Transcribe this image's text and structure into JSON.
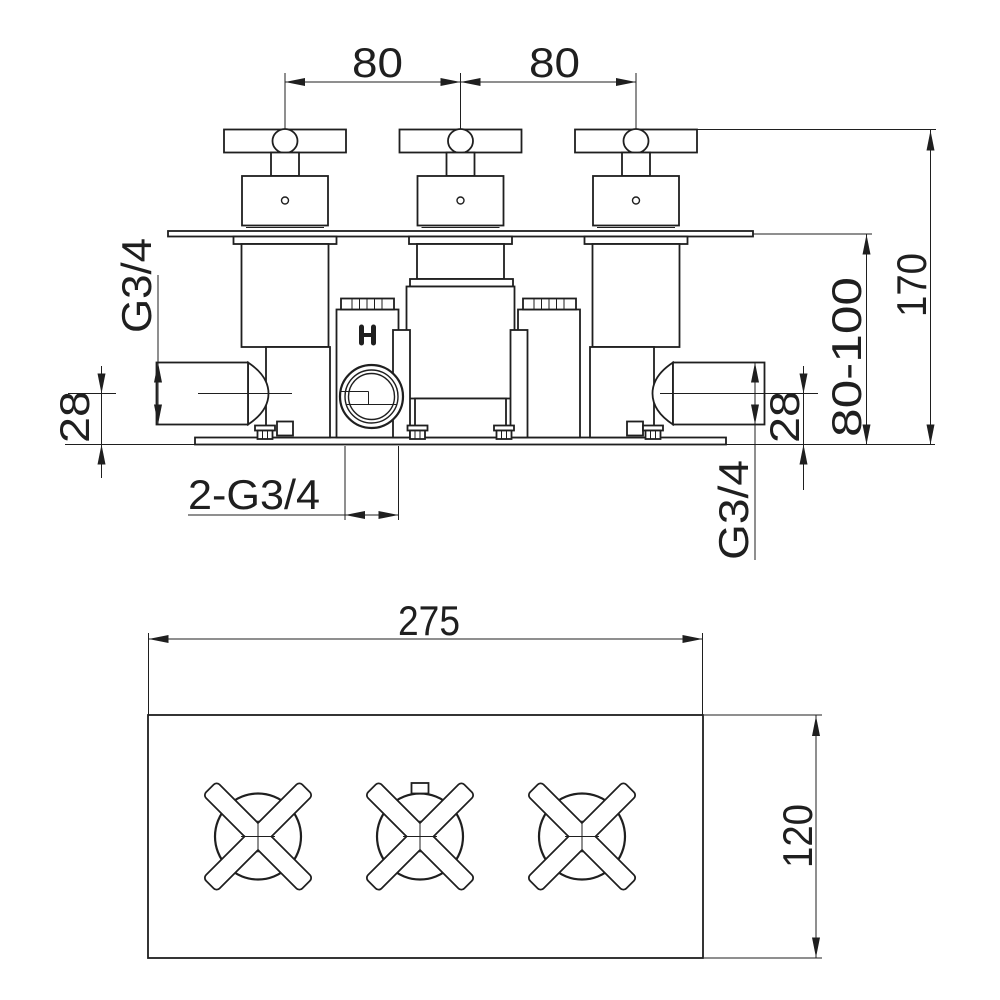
{
  "document": {
    "type": "technical dimension drawing",
    "subject": "3-handle concealed thermostatic valve, front elevation and face-plate plan view"
  },
  "colors": {
    "background": "#ffffff",
    "line": "#1f1f1f"
  },
  "front_view": {
    "dim_spacing_left": "80",
    "dim_spacing_right": "80",
    "dim_total_height": "170",
    "dim_depth_range": "80-100",
    "dim_port_thread_left": "G3/4",
    "dim_port_thread_right": "G3/4",
    "dim_port_offset_left": "28",
    "dim_port_offset_right": "28",
    "dim_bottom_ports": "2-G3/4",
    "marking_hot": "H"
  },
  "plan_view": {
    "dim_width": "275",
    "dim_height": "120"
  }
}
